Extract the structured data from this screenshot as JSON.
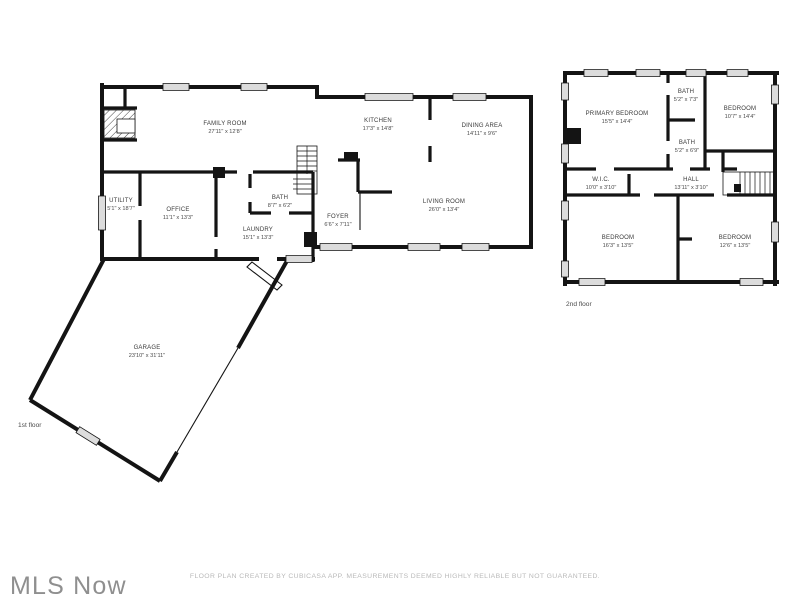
{
  "floors": {
    "first": {
      "label": "1st floor",
      "rooms": {
        "family_room": {
          "name": "FAMILY ROOM",
          "dims": "27'11\" x 12'8\""
        },
        "kitchen": {
          "name": "KITCHEN",
          "dims": "17'3\" x 14'8\""
        },
        "dining_area": {
          "name": "DINING AREA",
          "dims": "14'11\" x 9'6\""
        },
        "utility": {
          "name": "UTILITY",
          "dims": "5'1\" x 18'7\""
        },
        "office": {
          "name": "OFFICE",
          "dims": "11'1\" x 13'3\""
        },
        "bath": {
          "name": "BATH",
          "dims": "8'7\" x 6'2\""
        },
        "laundry": {
          "name": "LAUNDRY",
          "dims": "15'1\" x 13'3\""
        },
        "foyer": {
          "name": "FOYER",
          "dims": "6'6\" x 7'11\""
        },
        "living_room": {
          "name": "LIVING ROOM",
          "dims": "26'0\" x 13'4\""
        },
        "garage": {
          "name": "GARAGE",
          "dims": "23'10\" x 31'11\""
        }
      }
    },
    "second": {
      "label": "2nd floor",
      "rooms": {
        "primary_bedroom": {
          "name": "PRIMARY BEDROOM",
          "dims": "15'5\" x 14'4\""
        },
        "bath_top": {
          "name": "BATH",
          "dims": "5'2\" x 7'3\""
        },
        "bedroom_right": {
          "name": "BEDROOM",
          "dims": "10'7\" x 14'4\""
        },
        "bath_bottom": {
          "name": "BATH",
          "dims": "5'2\" x 6'9\""
        },
        "wic": {
          "name": "W.I.C.",
          "dims": "10'0\" x 3'10\""
        },
        "hall": {
          "name": "HALL",
          "dims": "13'11\" x 3'10\""
        },
        "bedroom_bottom_left": {
          "name": "BEDROOM",
          "dims": "16'3\" x 13'5\""
        },
        "bedroom_bottom_right": {
          "name": "BEDROOM",
          "dims": "12'6\" x 13'5\""
        }
      }
    }
  },
  "branding": {
    "logo": "MLS Now"
  },
  "footer": {
    "disclaimer": "FLOOR PLAN CREATED BY CUBICASA APP. MEASUREMENTS DEEMED HIGHLY RELIABLE BUT NOT GUARANTEED."
  },
  "colors": {
    "wall": "#141414",
    "window": "#dcdcdc",
    "room_label": "#3a3a3a",
    "dim_label": "#4a4a4a",
    "muted": "#b9b9b9",
    "logo": "#8f8f8f"
  }
}
